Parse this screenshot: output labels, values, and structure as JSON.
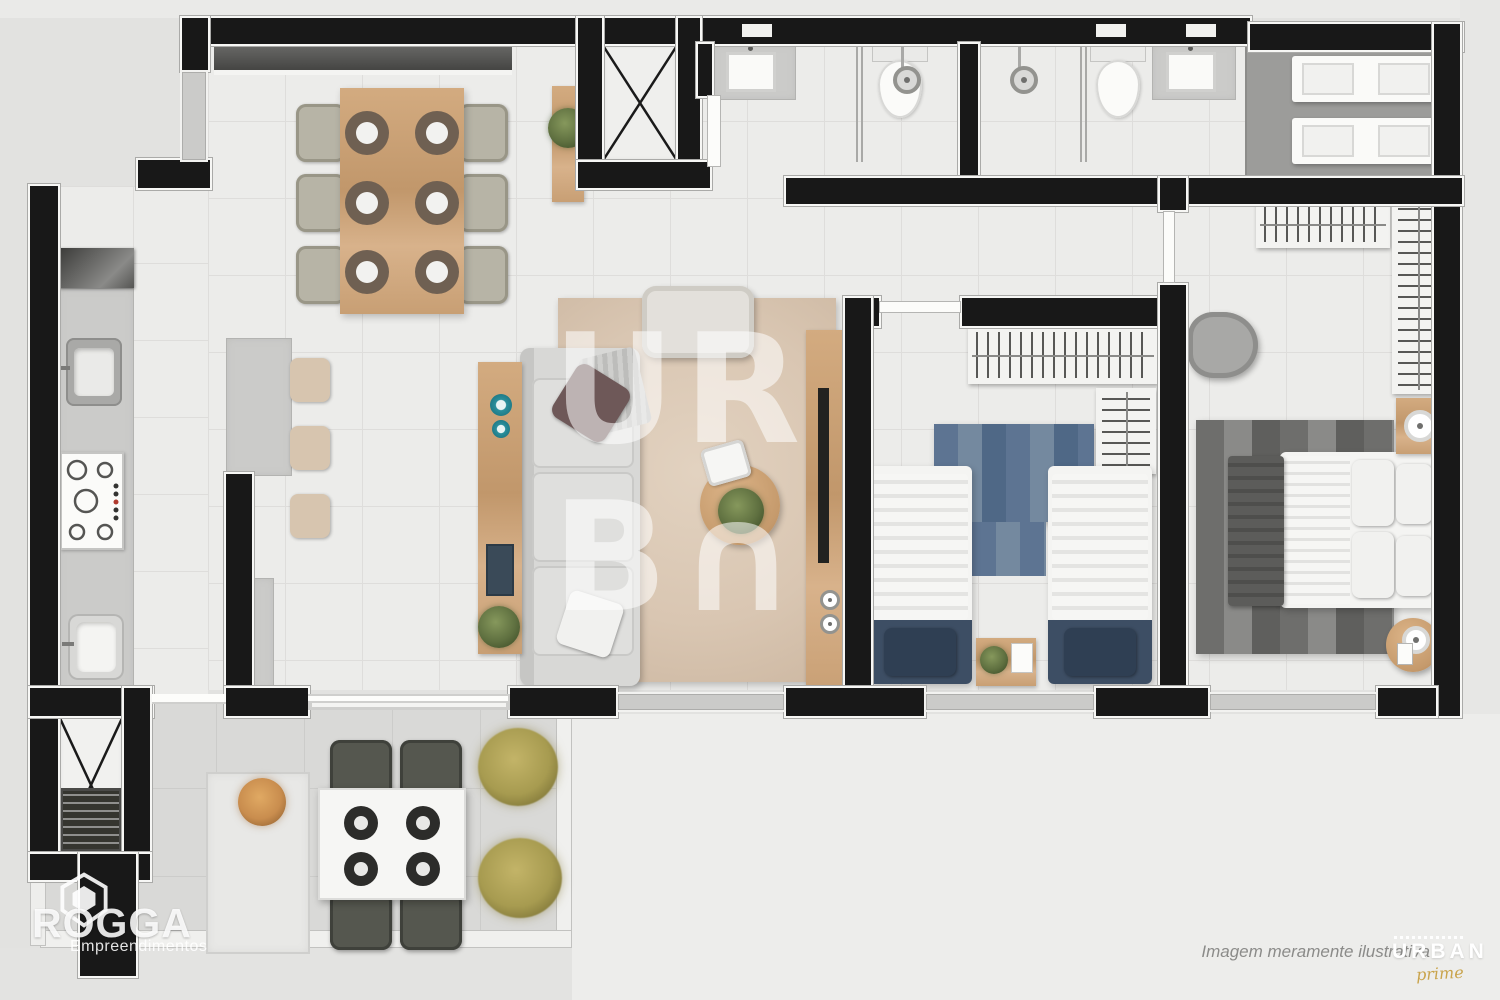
{
  "watermark": {
    "line1": "UR",
    "line2": "B∩"
  },
  "branding": {
    "developer": {
      "name": "ROGGA",
      "subtitle": "Empreendimentos"
    },
    "project": {
      "name": "URBAN",
      "script": "prime"
    }
  },
  "disclaimer": {
    "text": "Imagem meramente ilustrativa"
  },
  "colors": {
    "wall": "#181818",
    "wallEdge": "#f7f7f5",
    "floor": "#ececea",
    "grout": "#dedddb",
    "outside": "#e2e2e0",
    "balconyFloor": "#d9d9d7",
    "serviceFloor": "#9c9c9a",
    "wood": "#c8a076",
    "woodDark": "#b08457",
    "rug": "#d9c6b2",
    "sofa": "#d8d8d6",
    "navy": "#3d4e64",
    "blueRug": "#5d7492",
    "granite": "#cbcbc9",
    "plantGreen": "#5f7040",
    "plantGold": "#a79b50",
    "accentGold": "#c9a44c",
    "chairOutdoor": "#55574f",
    "chairDining": "#b7b4a6",
    "disclaimerText": "#8b8b89"
  }
}
